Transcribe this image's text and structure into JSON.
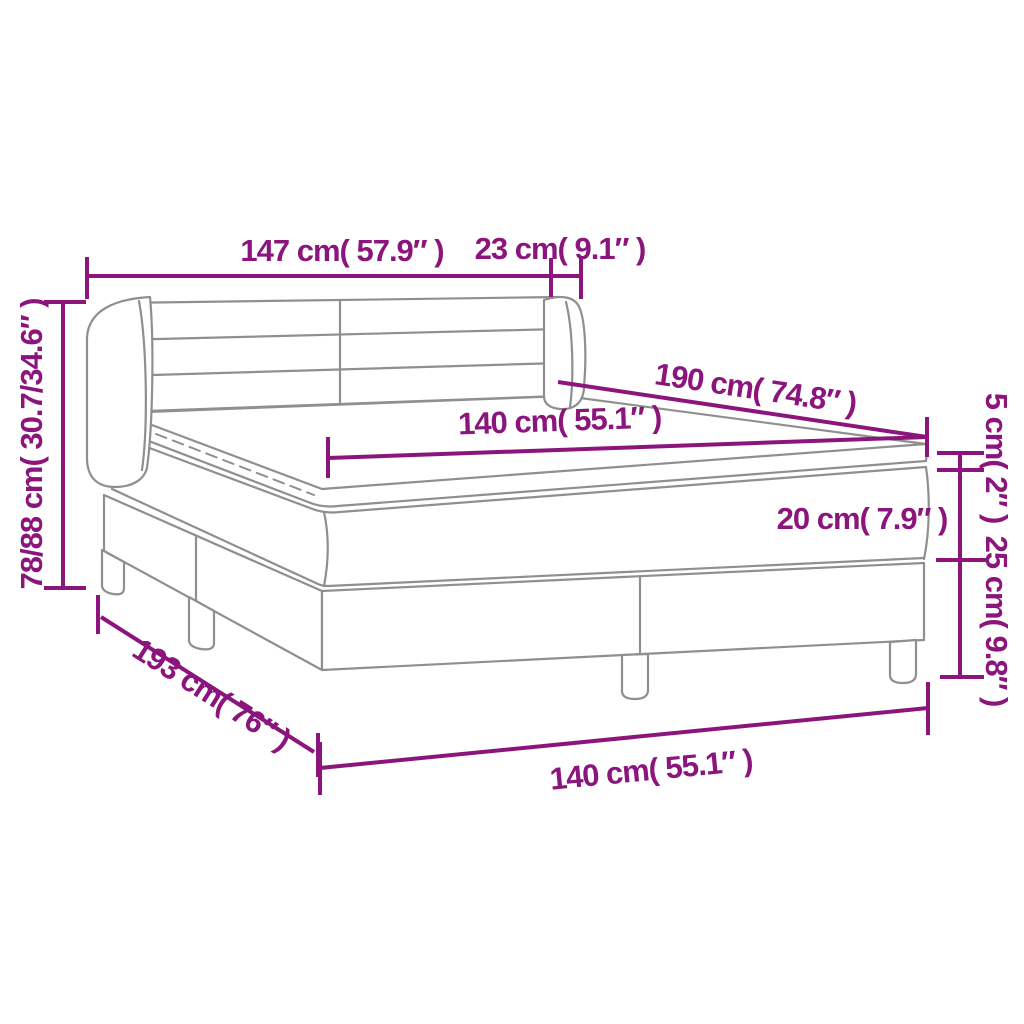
{
  "diagram": {
    "title": "Box spring bed dimension diagram",
    "colors": {
      "dimension_accent": "#8B157C",
      "drawing_outline": "#8F8F8F",
      "background": "#FFFFFF"
    },
    "labels": {
      "headboard_width": "147 cm( 57.9″ )",
      "headboard_side_depth": "23 cm( 9.1″ )",
      "overall_height": "78/88 cm( 30.7/34.6″ )",
      "bed_length": "190 cm( 74.8″ )",
      "mattress_width": "140 cm( 55.1″ )",
      "topper_thickness": "5 cm( 2″ )",
      "mattress_thickness": "20 cm( 7.9″ )",
      "base_height": "25 cm( 9.8″ )",
      "base_length": "193 cm( 76″ )",
      "base_width": "140 cm( 55.1″ )"
    }
  }
}
